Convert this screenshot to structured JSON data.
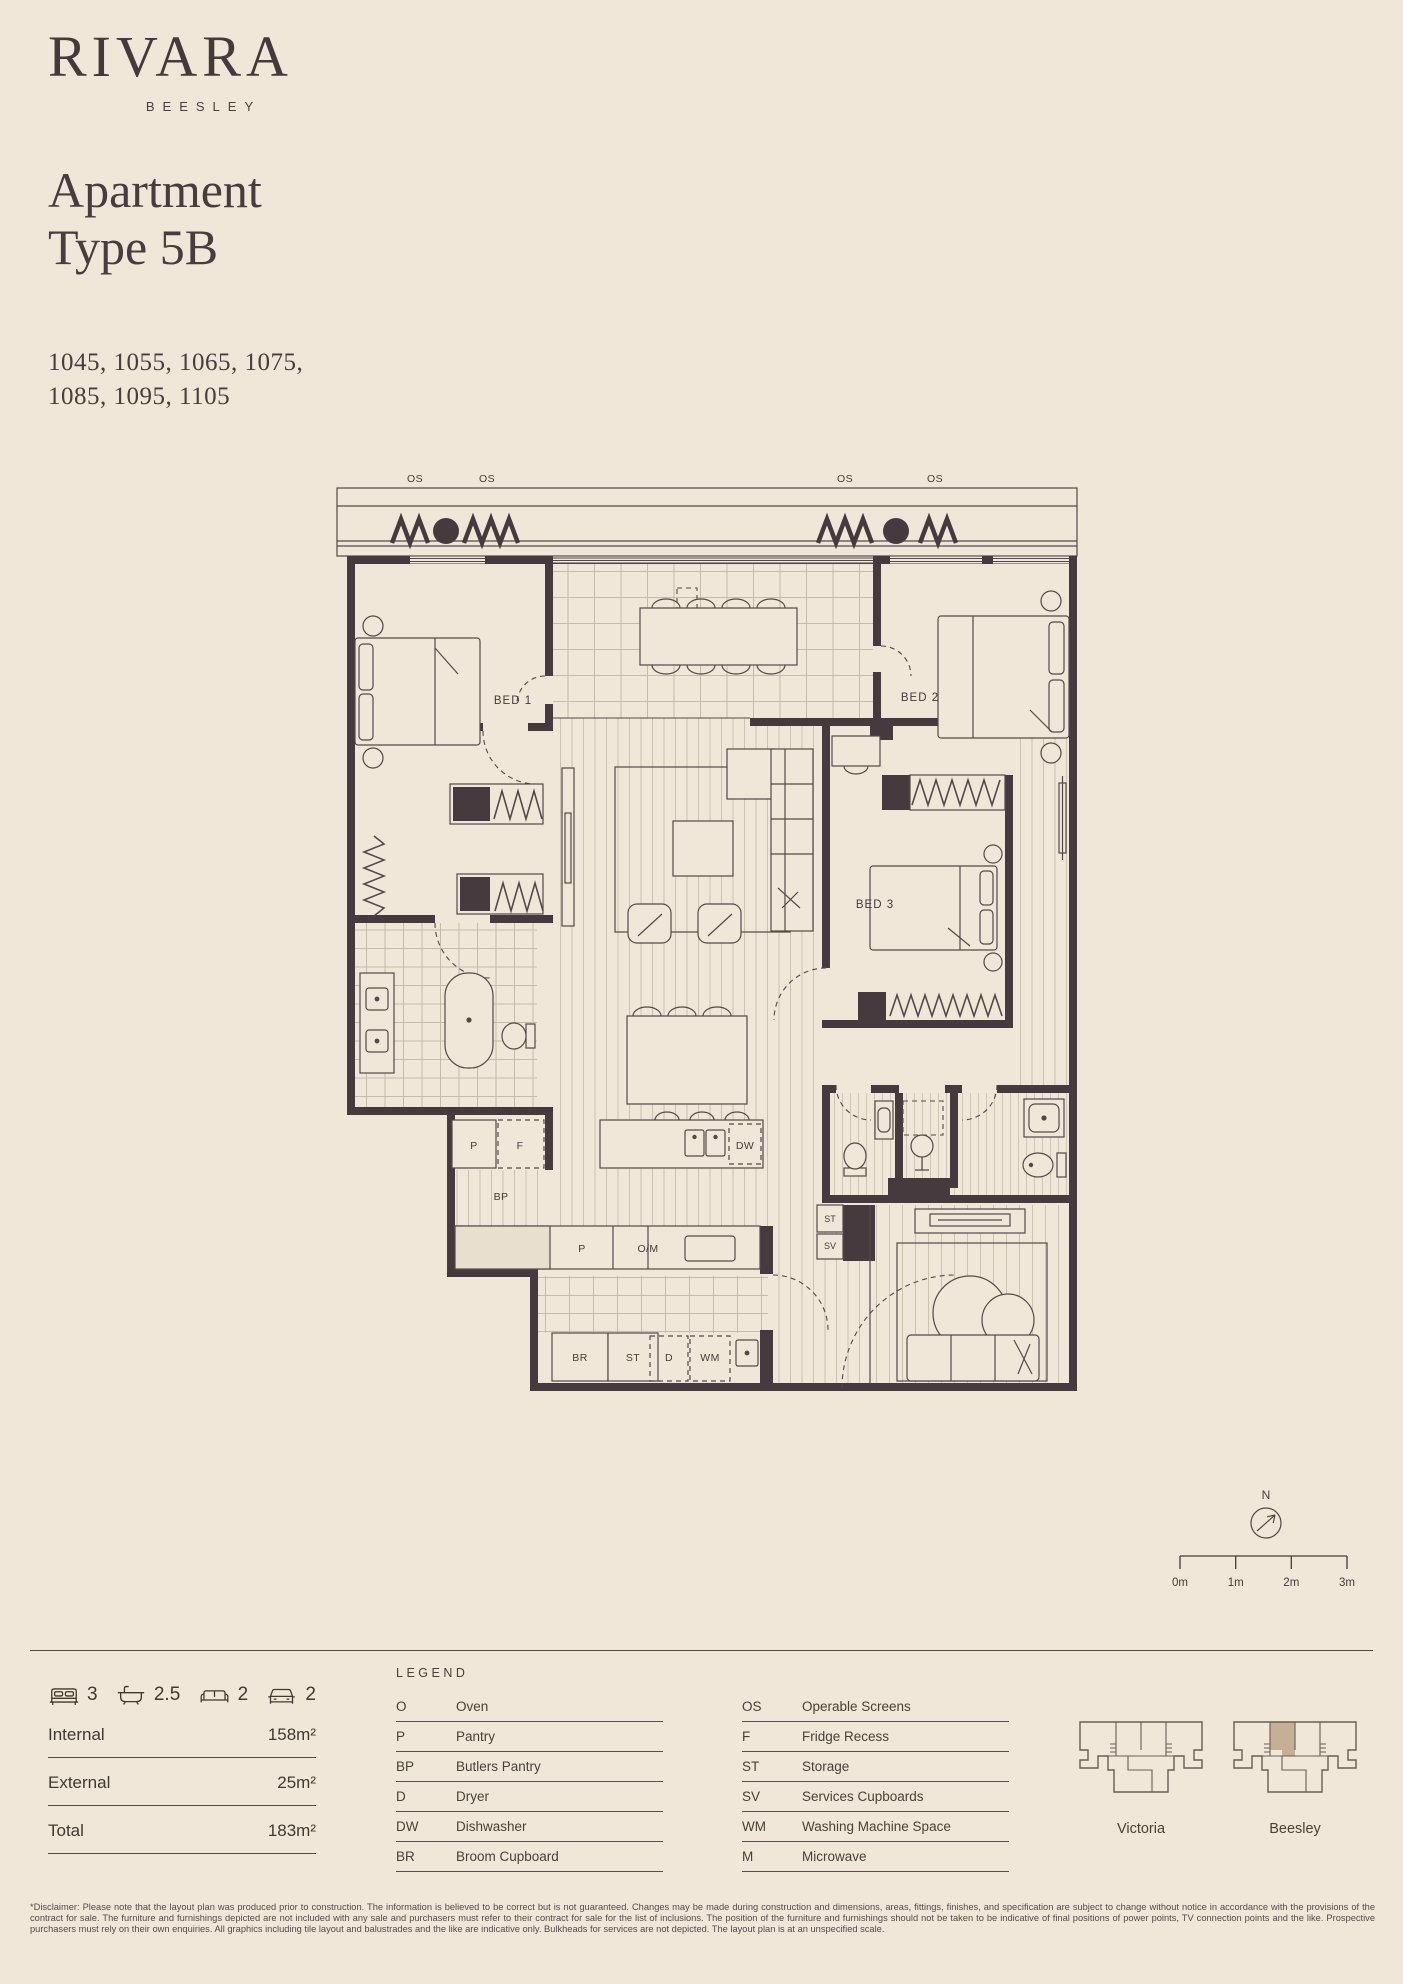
{
  "colors": {
    "background": "#f0e7d8",
    "ink": "#473a3e",
    "highlight": "#c6b095"
  },
  "brand": {
    "name": "RIVARA",
    "subtitle": "BEESLEY"
  },
  "title": {
    "line1": "Apartment",
    "line2": "Type 5B"
  },
  "apartment_numbers": {
    "line1": "1045, 1055, 1065, 1075,",
    "line2": "1085, 1095, 1105"
  },
  "plan": {
    "labels": {
      "os": "OS",
      "bed1": "BED 1",
      "bed2": "BED 2",
      "bed3": "BED 3",
      "pantry": "P",
      "fridge": "F",
      "butlers_pantry": "BP",
      "dishwasher": "DW",
      "oven_microwave": "O/M",
      "broom": "BR",
      "storage": "ST",
      "dryer": "D",
      "washing_machine": "WM",
      "services": "SV"
    }
  },
  "compass": {
    "north_label": "N"
  },
  "scale_bar": {
    "ticks": [
      "0m",
      "1m",
      "2m",
      "3m"
    ]
  },
  "summary": {
    "features": [
      {
        "icon": "bed-icon",
        "value": "3"
      },
      {
        "icon": "bath-icon",
        "value": "2.5"
      },
      {
        "icon": "sofa-icon",
        "value": "2"
      },
      {
        "icon": "car-icon",
        "value": "2"
      }
    ],
    "areas": [
      {
        "label": "Internal",
        "value": "158m²"
      },
      {
        "label": "External",
        "value": "25m²"
      },
      {
        "label": "Total",
        "value": "183m²"
      }
    ]
  },
  "legend": {
    "heading": "LEGEND",
    "column1": [
      {
        "abbr": "O",
        "label": "Oven"
      },
      {
        "abbr": "P",
        "label": "Pantry"
      },
      {
        "abbr": "BP",
        "label": "Butlers Pantry"
      },
      {
        "abbr": "D",
        "label": "Dryer"
      },
      {
        "abbr": "DW",
        "label": "Dishwasher"
      },
      {
        "abbr": "BR",
        "label": "Broom Cupboard"
      }
    ],
    "column2": [
      {
        "abbr": "OS",
        "label": "Operable Screens"
      },
      {
        "abbr": "F",
        "label": "Fridge Recess"
      },
      {
        "abbr": "ST",
        "label": "Storage"
      },
      {
        "abbr": "SV",
        "label": "Services Cupboards"
      },
      {
        "abbr": "WM",
        "label": "Washing Machine Space"
      },
      {
        "abbr": "M",
        "label": "Microwave"
      }
    ]
  },
  "buildings": [
    {
      "name": "Victoria",
      "highlighted": false
    },
    {
      "name": "Beesley",
      "highlighted": true
    }
  ],
  "disclaimer": "*Disclaimer: Please note that the layout plan was produced prior to construction. The information is believed to be correct but is not guaranteed. Changes may be made during construction and dimensions, areas, fittings, finishes, and specification are subject to change without notice in accordance with the provisions of the contract for sale. The furniture and furnishings depicted are not included with any sale and purchasers must refer to their contract for sale for the list of inclusions. The position of the furniture and furnishings should not be taken to be indicative of final positions of power points, TV connection points and the like. Prospective purchasers must rely on their own enquiries. All graphics including tile layout and balustrades and the like are indicative only. Bulkheads for services are not depicted. The layout plan is at an unspecified scale."
}
